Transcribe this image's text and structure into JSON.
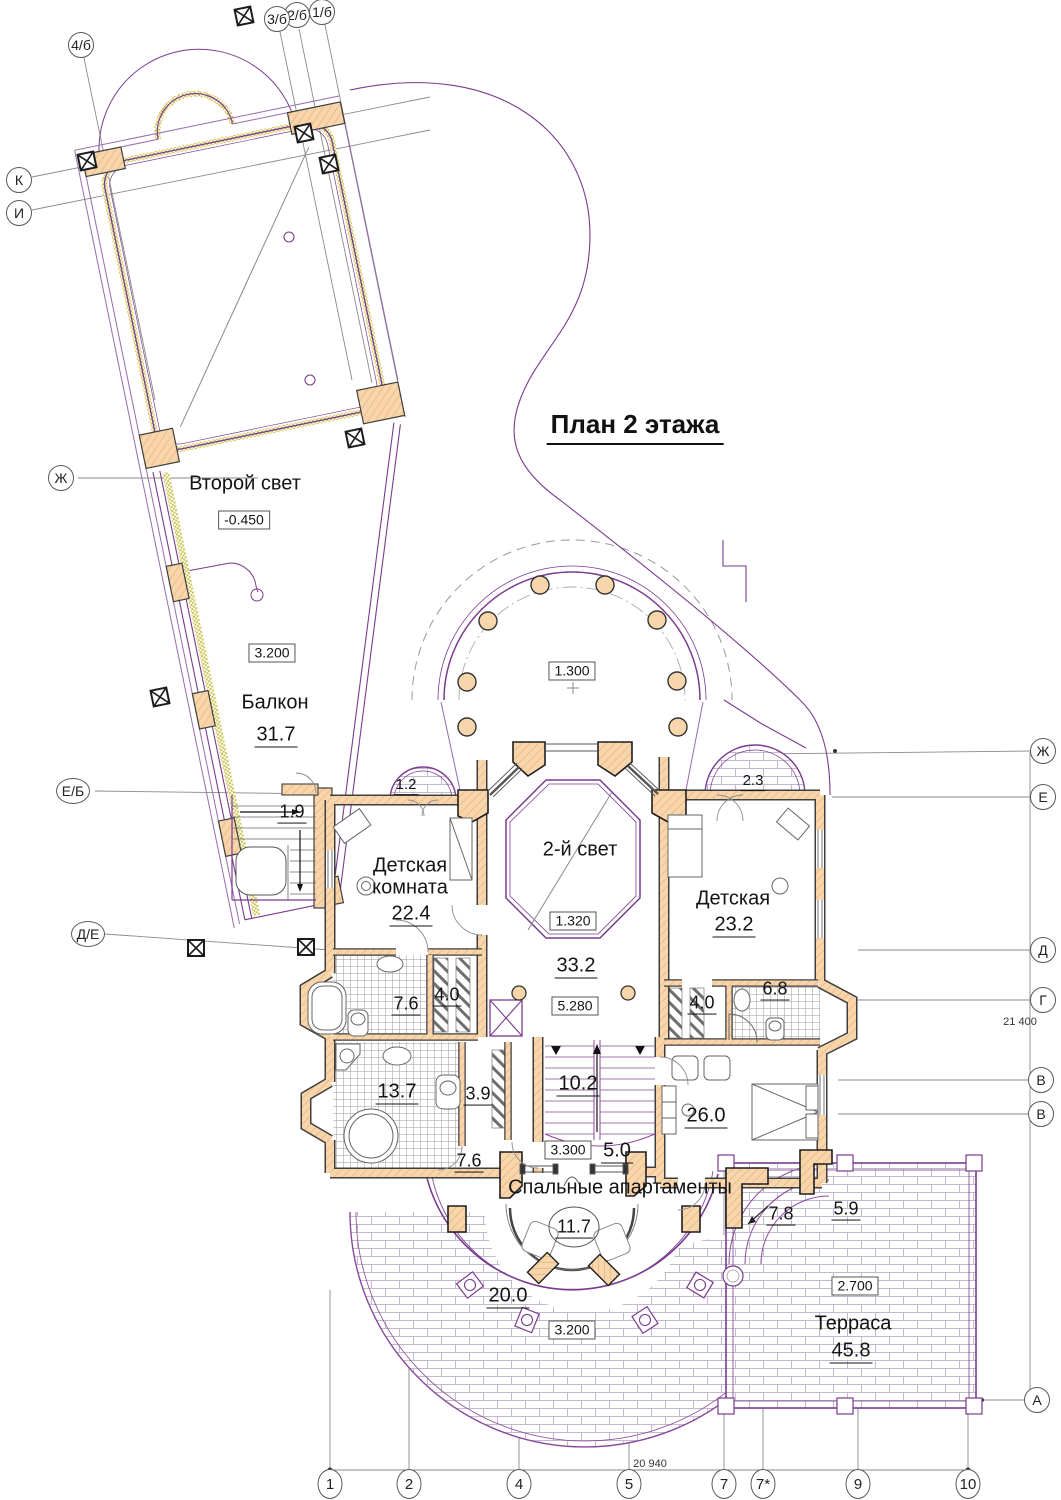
{
  "title": "План 2 этажа",
  "axes": {
    "top": [
      "4/б",
      "3/б",
      "2/б",
      "1/б"
    ],
    "left": [
      "К",
      "И",
      "Ж",
      "Е/Б",
      "Д/Е"
    ],
    "right": [
      "Ж",
      "Е",
      "Д",
      "Г",
      "В",
      "В",
      "А"
    ],
    "bottom": [
      "1",
      "2",
      "4",
      "5",
      "7",
      "7*",
      "9",
      "10"
    ]
  },
  "dimensions": {
    "bottom": "20 940",
    "right": "21 400"
  },
  "levels": {
    "upper_hall": "-0.450",
    "wing_balcony": "3.200",
    "colonnade": "1.300",
    "second_light_floor": "1.320",
    "second_light_h": "5.280",
    "stairs": "3.300",
    "terrace": "2.700",
    "lower_balcony": "3.200"
  },
  "rooms": {
    "upper_hall": {
      "name": "Второй свет"
    },
    "wing_balcony": {
      "name": "Балкон",
      "area": "31.7"
    },
    "stair_landing": {
      "area": "1.9"
    },
    "balcony_left": {
      "area": "1.2"
    },
    "balcony_right": {
      "area": "2.3"
    },
    "nursery_left": {
      "name": "Детская",
      "name2": "комната",
      "area": "22.4"
    },
    "second_light": {
      "name": "2-й свет",
      "area": "33.2"
    },
    "nursery_right": {
      "name": "Детская",
      "area": "23.2"
    },
    "bathroom_left": {
      "area": "7.6"
    },
    "closet_left": {
      "area": "4.0"
    },
    "closet_right": {
      "area": "4.0"
    },
    "bathroom_right": {
      "area": "6.8"
    },
    "bathroom_master": {
      "area": "13.7"
    },
    "closet_master": {
      "area": "3.9"
    },
    "staircase": {
      "area": "10.2"
    },
    "hall": {
      "area": "7.6"
    },
    "landing": {
      "area": "5.0"
    },
    "suite_label": "Спальные апартаменты",
    "master_bedroom": {
      "area": "26.0"
    },
    "round_balcony": {
      "area": "11.7"
    },
    "lower_terrace": {
      "area": "20.0"
    },
    "steps_left": {
      "area": "7.8"
    },
    "steps_right": {
      "area": "5.9"
    },
    "terrace": {
      "name": "Терраса",
      "area": "45.8"
    }
  },
  "colors": {
    "wall_fill": "#f8d6ac",
    "wall_hatch": "#e9ab76",
    "line_purple": "#7a3b8f",
    "line_gray": "#8a8a8a",
    "olive": "#c9c24e",
    "brick_line": "#c3b9ce"
  }
}
